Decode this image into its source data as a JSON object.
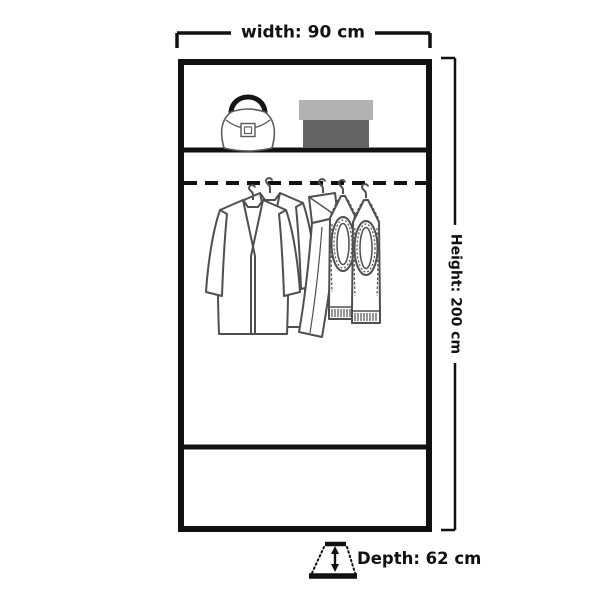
{
  "diagram": {
    "kind": "wardrobe-dimension-diagram",
    "labels": {
      "width": "width: 90 cm",
      "height": "Height: 200 cm",
      "depth": "Depth: 62 cm"
    },
    "dimensions_cm": {
      "width": 90,
      "height": 200,
      "depth": 62
    },
    "colors": {
      "outline": "#111111",
      "clothing_stroke": "#4f4f4f",
      "box_lid": "#b2b2b2",
      "box_body": "#646464",
      "background": "#ffffff"
    },
    "contents": {
      "top_shelf": [
        "handbag",
        "storage box"
      ],
      "hanging_rail": [
        "jacket",
        "jacket",
        "trousers",
        "knit vest",
        "knit vest"
      ]
    }
  }
}
